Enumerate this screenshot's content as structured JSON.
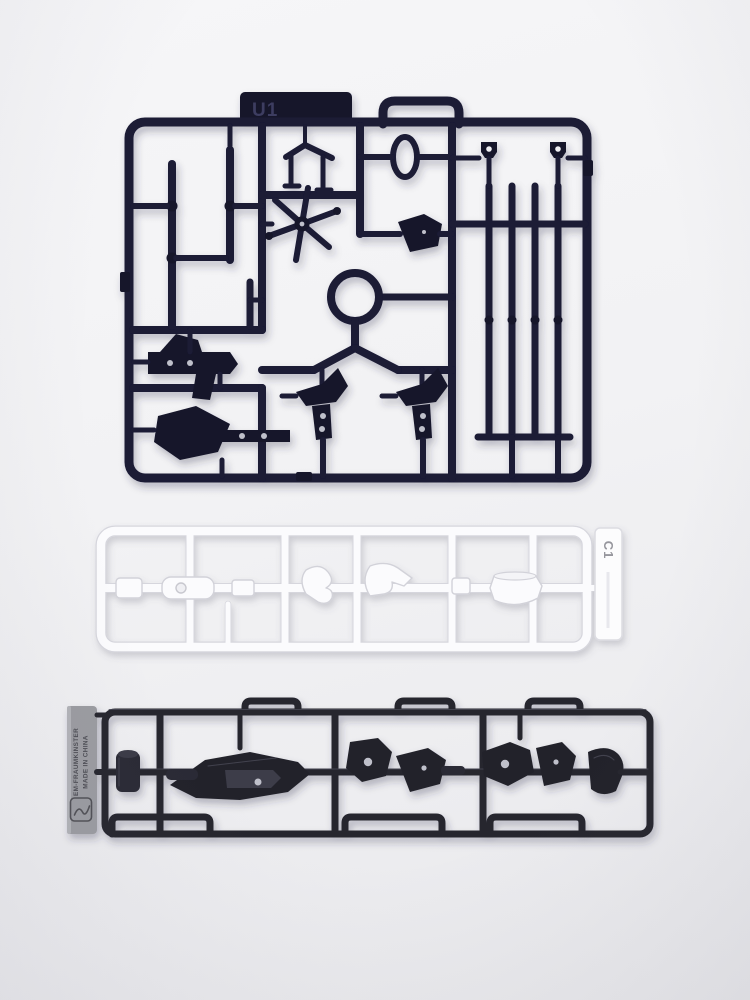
{
  "scene": {
    "description": "Photograph of three injection-molded model-kit part runners (sprues) lying on a pale grey surface",
    "background_color": "#f2f2f4"
  },
  "runners": {
    "top": {
      "tag_label": "U1",
      "plastic_color": "#16162e",
      "kind": "dark navy rectangular runner with rod, antenna, star, ring, pistol and clamp parts"
    },
    "middle": {
      "tag_label": "C1",
      "plastic_color": "#fbfbfc",
      "kind": "white horizontal strip runner with small parts on a center rail"
    },
    "bottom": {
      "tag_label_line1": "EM-FRAUMKINSTER",
      "tag_label_line2": "MADE IN CHINA",
      "plastic_color": "#26262f",
      "kind": "dark grey horizontal strip runner with articulated joint parts"
    }
  }
}
